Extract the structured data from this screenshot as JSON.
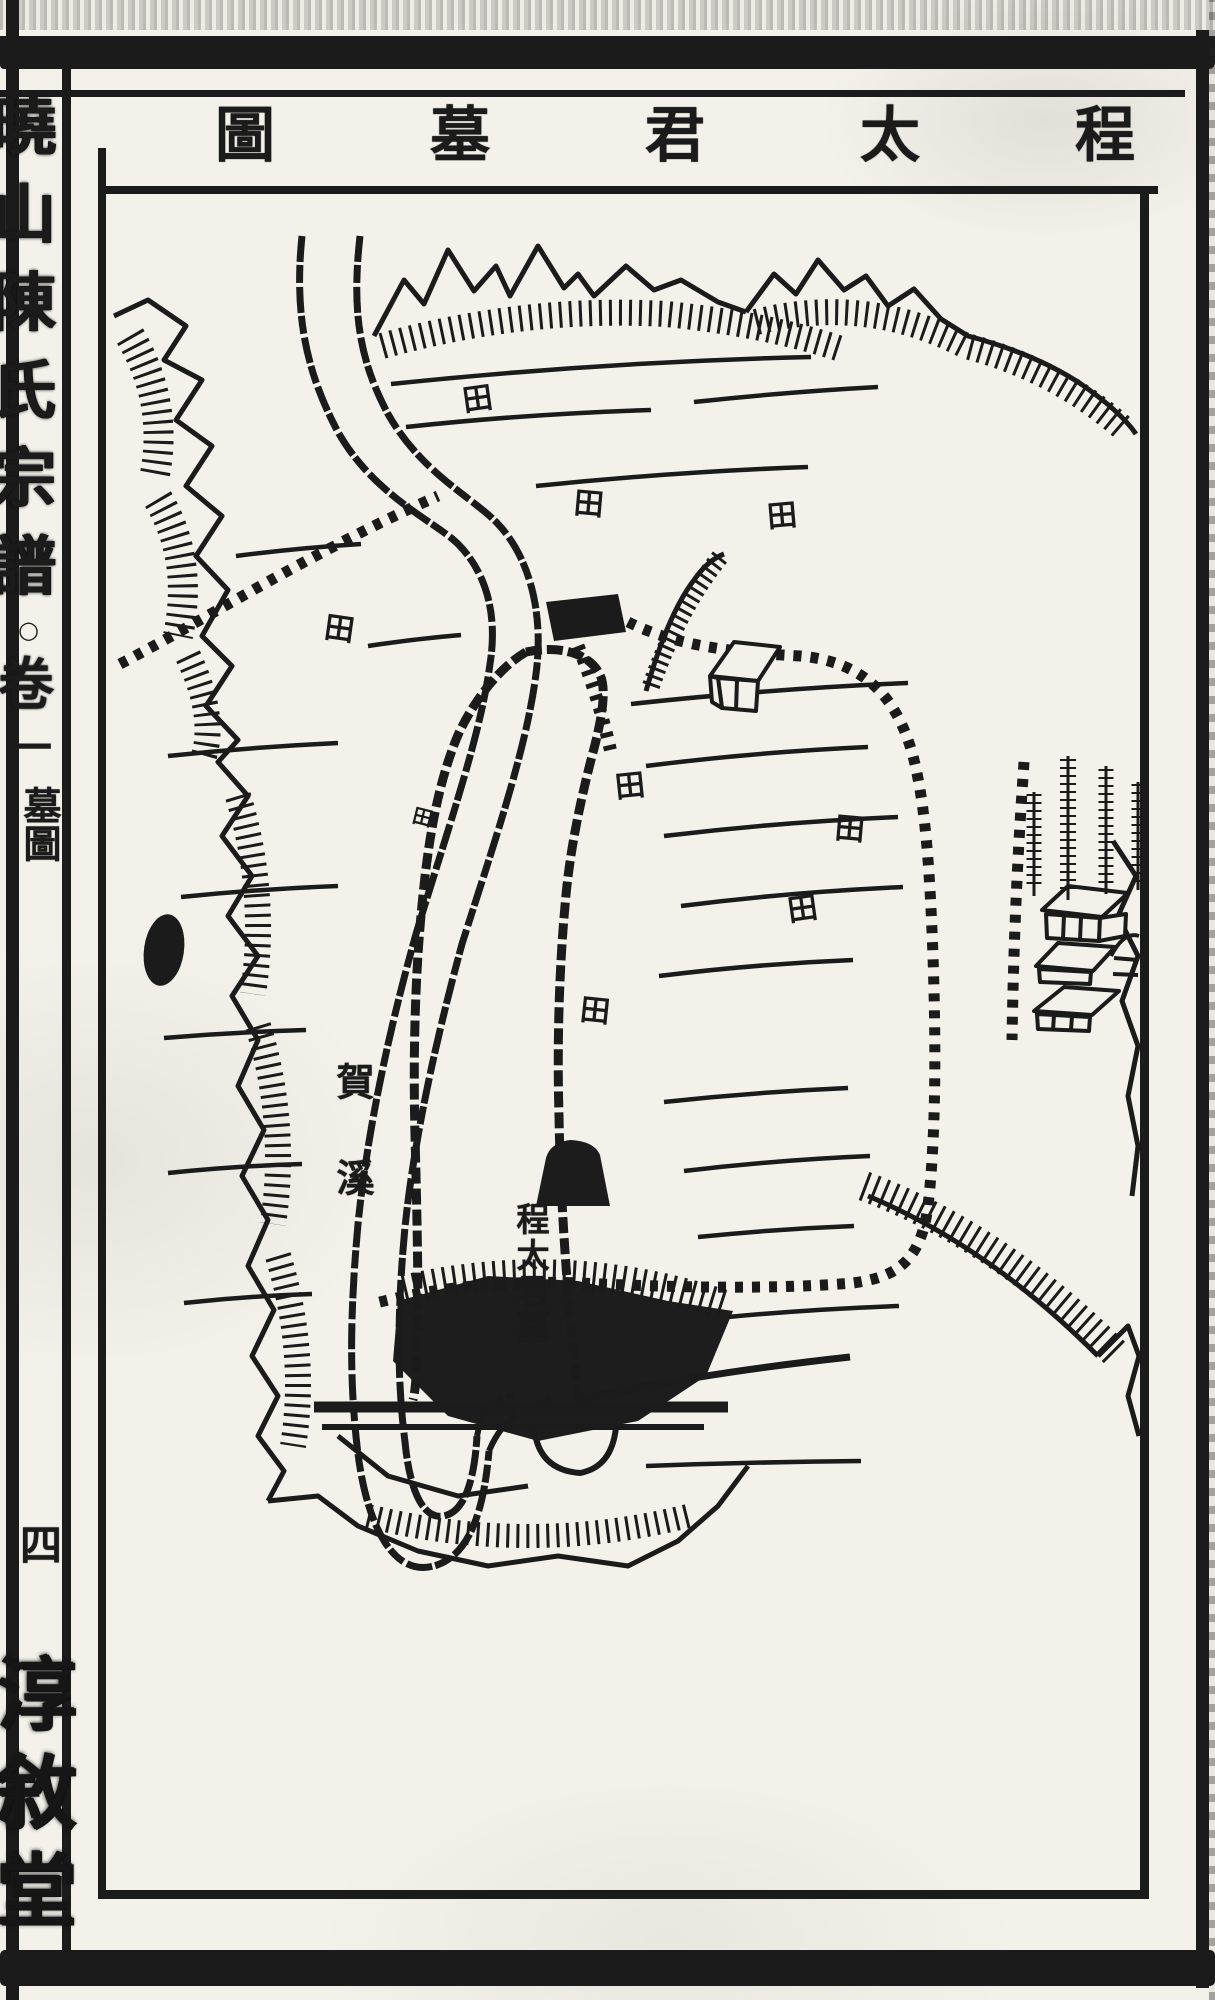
{
  "header": {
    "title_full": "程太君墓圖",
    "title_chars": [
      "程",
      "太",
      "君",
      "墓",
      "圖"
    ]
  },
  "spine": {
    "book_title": "曉山陳氏宗譜",
    "book_title_chars": [
      "曉",
      "山",
      "陳",
      "氏",
      "宗",
      "譜"
    ],
    "volume_marker": "○",
    "volume_char": "卷",
    "volume_number": "一",
    "section_label": "墓圖",
    "page_number": "四",
    "hall_mark_chars": [
      "淳",
      "敘",
      "堂"
    ]
  },
  "map": {
    "river_label": "賀溪",
    "grave_label": "程太君墓",
    "field_marker": "田"
  },
  "colors": {
    "ink": "#1b1b1b",
    "paper": "#f3f1ea"
  }
}
